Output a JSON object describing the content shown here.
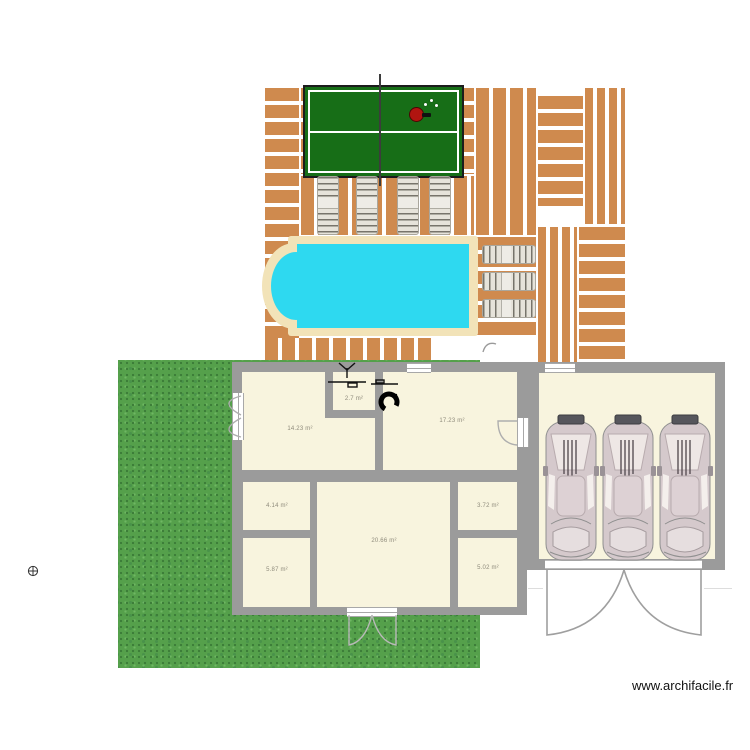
{
  "app": {
    "watermark": "www.archifacile.fr"
  },
  "colors": {
    "deck_plank": "#cf8a4e",
    "pool_water": "#2ed9f0",
    "pool_border": "#f2e3b8",
    "grass": "#55a04b",
    "wall": "#9b9b9b",
    "room_fill": "#f8f4de",
    "table_tennis_green": "#176e17",
    "paddle_red": "#b01510",
    "car_body": "#d5c9cc"
  },
  "rooms": [
    {
      "name": "room-top-left",
      "area": "14.23 m²"
    },
    {
      "name": "bathroom",
      "area": "2.7 m²"
    },
    {
      "name": "room-top-right",
      "area": "17.23 m²"
    },
    {
      "name": "room-mid-left",
      "area": "4.14 m²"
    },
    {
      "name": "room-bottom-left",
      "area": "5.87 m²"
    },
    {
      "name": "room-center",
      "area": "20.66 m²"
    },
    {
      "name": "room-mid-right",
      "area": "3.72 m²"
    },
    {
      "name": "room-bottom-right",
      "area": "5.02 m²"
    }
  ],
  "outdoor": {
    "loungers_below_table": 4,
    "loungers_right_of_pool": 3,
    "cars_in_garage": 3
  }
}
